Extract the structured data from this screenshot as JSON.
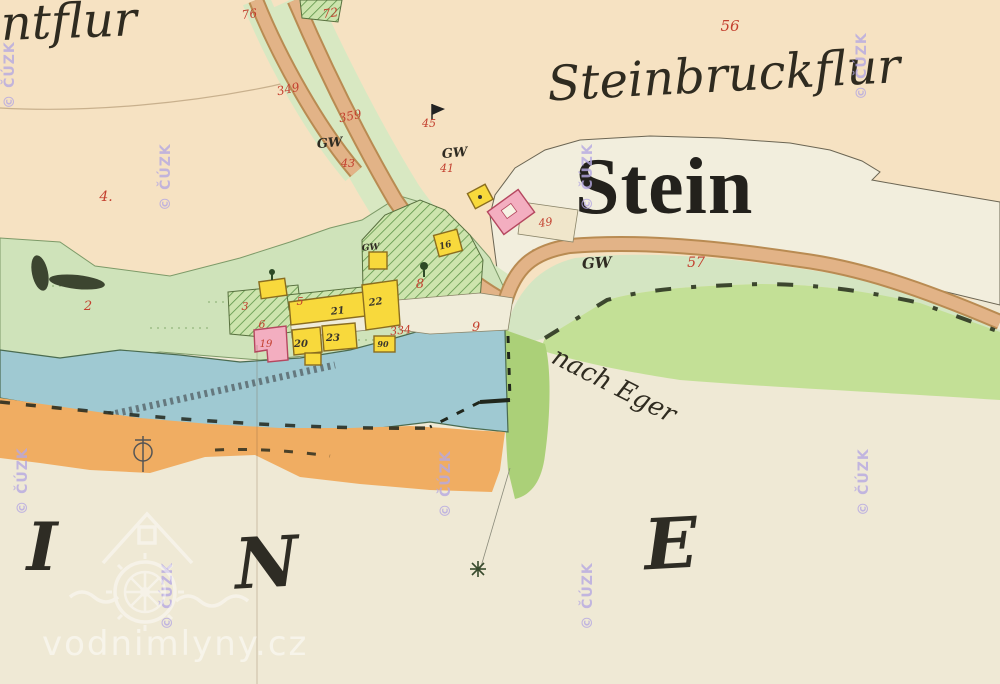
{
  "map_type": "historical-cadastral-map",
  "labels": {
    "flur_top_left": "intflur",
    "flur_top_right": "Steinbruckflur",
    "settlement": "Stein",
    "road_destination": "nach Eger",
    "watermark_site": "vodnimlyny.cz",
    "watermark_copyright": "© ČÚZK"
  },
  "big_letters": [
    {
      "t": "I",
      "x": 42,
      "y": 570,
      "s": 66,
      "r": 0
    },
    {
      "t": "N",
      "x": 268,
      "y": 587,
      "s": 70,
      "r": -3
    },
    {
      "t": "E",
      "x": 672,
      "y": 568,
      "s": 70,
      "r": -3
    }
  ],
  "red_parcel_numbers": [
    {
      "t": "56",
      "x": 730,
      "y": 31,
      "s": 15
    },
    {
      "t": "76",
      "x": 250,
      "y": 18,
      "s": 12,
      "r": -8
    },
    {
      "t": "72",
      "x": 331,
      "y": 17,
      "s": 12,
      "r": -8
    },
    {
      "t": "349",
      "x": 289,
      "y": 93,
      "s": 12,
      "r": -12
    },
    {
      "t": "359",
      "x": 351,
      "y": 120,
      "s": 12,
      "r": -12
    },
    {
      "t": "4.",
      "x": 106,
      "y": 201,
      "s": 14
    },
    {
      "t": "43",
      "x": 348,
      "y": 167,
      "s": 11
    },
    {
      "t": "45",
      "x": 429,
      "y": 127,
      "s": 11
    },
    {
      "t": "41",
      "x": 447,
      "y": 172,
      "s": 11
    },
    {
      "t": "2",
      "x": 88,
      "y": 310,
      "s": 13
    },
    {
      "t": "3",
      "x": 245,
      "y": 310,
      "s": 11
    },
    {
      "t": "6",
      "x": 262,
      "y": 328,
      "s": 11
    },
    {
      "t": "5",
      "x": 300,
      "y": 305,
      "s": 11
    },
    {
      "t": "8",
      "x": 420,
      "y": 288,
      "s": 13
    },
    {
      "t": "9",
      "x": 476,
      "y": 331,
      "s": 13
    },
    {
      "t": "334",
      "x": 401,
      "y": 334,
      "s": 11,
      "r": -6
    },
    {
      "t": "57",
      "x": 696,
      "y": 267,
      "s": 14
    },
    {
      "t": "49",
      "x": 546,
      "y": 226,
      "s": 11,
      "r": -8
    },
    {
      "t": "19",
      "x": 266,
      "y": 347,
      "s": 10
    }
  ],
  "black_house_numbers": [
    {
      "t": "22",
      "x": 376,
      "y": 305,
      "s": 10,
      "r": -8
    },
    {
      "t": "21",
      "x": 338,
      "y": 314,
      "s": 10,
      "r": -6
    },
    {
      "t": "20",
      "x": 301,
      "y": 347,
      "s": 10
    },
    {
      "t": "23",
      "x": 333,
      "y": 341,
      "s": 10
    },
    {
      "t": "90",
      "x": 383,
      "y": 347,
      "s": 8
    },
    {
      "t": "16",
      "x": 446,
      "y": 248,
      "s": 9,
      "r": -15
    }
  ],
  "land_use_labels": [
    {
      "t": "GW",
      "x": 330,
      "y": 147,
      "s": 13,
      "r": -5
    },
    {
      "t": "GW",
      "x": 455,
      "y": 157,
      "s": 13,
      "r": -5
    },
    {
      "t": "GW",
      "x": 597,
      "y": 268,
      "s": 15,
      "r": -3
    },
    {
      "t": "GW",
      "x": 371,
      "y": 250,
      "s": 9,
      "r": -5
    }
  ],
  "cuzk_watermark": {
    "text": "© ČÚZK",
    "positions": [
      {
        "x": 14,
        "y": 75
      },
      {
        "x": 170,
        "y": 177
      },
      {
        "x": 592,
        "y": 177
      },
      {
        "x": 866,
        "y": 66
      },
      {
        "x": 27,
        "y": 481
      },
      {
        "x": 450,
        "y": 484
      },
      {
        "x": 868,
        "y": 482
      },
      {
        "x": 172,
        "y": 596
      },
      {
        "x": 592,
        "y": 596
      }
    ]
  },
  "colors": {
    "peach_field": "#f6e2c2",
    "cream_bottom": "#efe9d5",
    "village_white": "#f2eedd",
    "meadow_green": "#cfe3ba",
    "bright_green": "#c3e096",
    "pond_blue": "#9fc9d2",
    "road_orange": "#f0ad62",
    "road_tan": "#e2b387",
    "building_wood_yellow": "#f8d93c",
    "building_masonry_pink": "#f3aec0",
    "parcel_number_red": "#c3402f",
    "watermark_purple": "#b6a9e2"
  }
}
